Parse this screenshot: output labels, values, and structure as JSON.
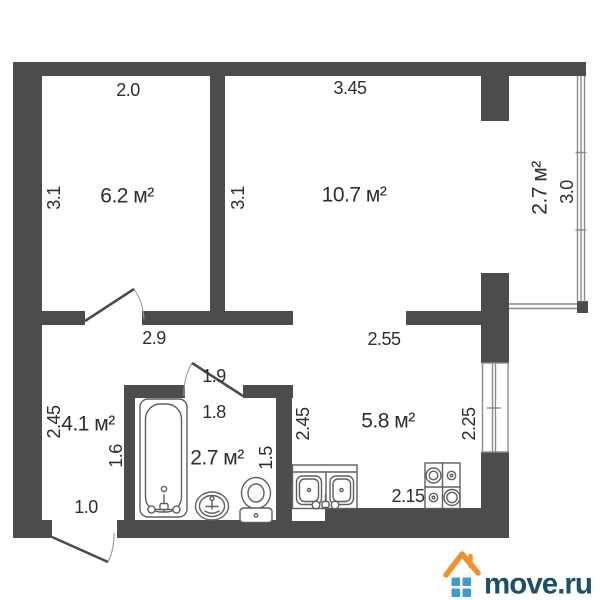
{
  "colors": {
    "wall": "#4c4c4c",
    "window_line": "#8a8a8a",
    "fixture_line": "#5f5f5f",
    "label_text": "#2e2e2e",
    "logo_roof": "#f0912d",
    "logo_squares": "#3d9bd1",
    "logo_text": "#1d4f66",
    "background": "#ffffff"
  },
  "rooms": {
    "room_top_left": {
      "area": "6.2 м²"
    },
    "room_top_right": {
      "area": "10.7 м²"
    },
    "balcony": {
      "area": "2.7 м²"
    },
    "hallway": {
      "area": "4.1 м²"
    },
    "bathroom": {
      "area": "2.7 м²"
    },
    "kitchen": {
      "area": "5.8 м²"
    }
  },
  "dimensions": {
    "room_top_left_width": "2.0",
    "room_top_right_width": "3.45",
    "room_top_left_depth": "3.1",
    "room_top_right_depth": "3.1",
    "balcony_length": "3.0",
    "hallway_top_width": "2.9",
    "kitchen_top_width": "2.55",
    "hallway_depth": "2.45",
    "kitchen_depth": "2.45",
    "kitchen_window_span": "2.25",
    "bathroom_door_span": "1.9",
    "bathroom_top_width": "1.8",
    "bathroom_left_depth": "1.6",
    "bathroom_right_depth": "1.5",
    "entry_opening_width": "1.0",
    "kitchen_bottom_width": "2.15"
  },
  "branding": {
    "logo_text": "move.ru"
  }
}
